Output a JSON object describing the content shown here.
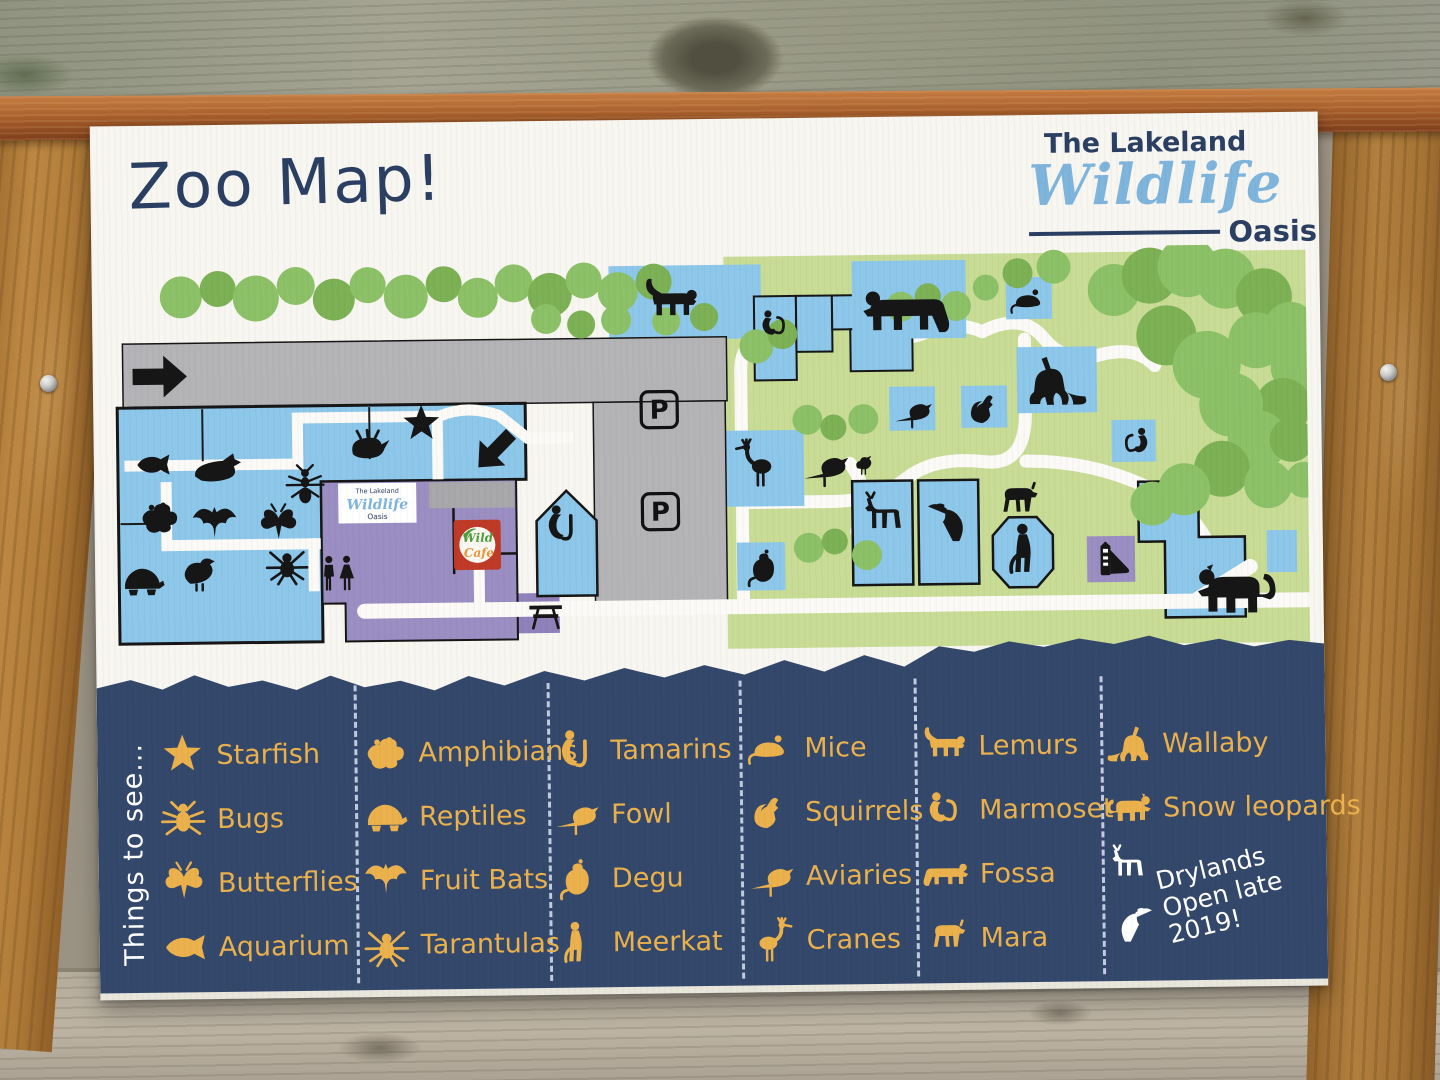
{
  "title": "Zoo Map!",
  "logo": {
    "top": "The Lakeland",
    "script": "Wildlife",
    "bottom": "Oasis"
  },
  "colors": {
    "navy_band": "#33486b",
    "gold": "#ebb14c",
    "sign_bg": "#f8f6f0",
    "map_green": "#c8dc96",
    "tree_green": "#8cc168",
    "enclosure_blue": "#8dc7ea",
    "parking_gray": "#b4b3b6",
    "building_purple": "#9b8ec3",
    "cafe_red": "#c03a28",
    "cafe_green": "#4e9c3c",
    "cafe_orange": "#e8953c",
    "logo_blue": "#7fb5dc",
    "logo_navy": "#2b3f63"
  },
  "map": {
    "parking_label": "P",
    "cafe": {
      "line1": "Wild",
      "line2": "Cafe"
    },
    "mini_sign": {
      "top": "The Lakeland",
      "script": "Wildlife",
      "bottom": "Oasis"
    },
    "markers": [
      {
        "icon": "clownfish",
        "x": 26,
        "y": 188,
        "s": 38
      },
      {
        "icon": "seal",
        "x": 84,
        "y": 182,
        "s": 52
      },
      {
        "icon": "conch",
        "x": 238,
        "y": 170,
        "s": 46
      },
      {
        "icon": "starfish",
        "x": 292,
        "y": 148,
        "s": 44
      },
      {
        "icon": "ant",
        "x": 176,
        "y": 208,
        "s": 42
      },
      {
        "icon": "frog",
        "x": 28,
        "y": 238,
        "s": 44
      },
      {
        "icon": "bat",
        "x": 82,
        "y": 244,
        "s": 48
      },
      {
        "icon": "butterfly",
        "x": 148,
        "y": 246,
        "s": 44
      },
      {
        "icon": "turtle",
        "x": 10,
        "y": 300,
        "s": 46
      },
      {
        "icon": "quail",
        "x": 70,
        "y": 292,
        "s": 44
      },
      {
        "icon": "spider",
        "x": 156,
        "y": 286,
        "s": 44
      },
      {
        "icon": "toilets",
        "x": 208,
        "y": 298,
        "s": 42
      },
      {
        "icon": "lemur",
        "x": 536,
        "y": 22,
        "s": 58
      },
      {
        "icon": "tamarin",
        "x": 432,
        "y": 250,
        "s": 44
      },
      {
        "icon": "marmoset",
        "x": 650,
        "y": 56,
        "s": 38
      },
      {
        "icon": "fossa",
        "x": 756,
        "y": 18,
        "s": 88,
        "flip": true
      },
      {
        "icon": "mouse",
        "x": 904,
        "y": 34,
        "s": 38
      },
      {
        "icon": "crane",
        "x": 624,
        "y": 188,
        "s": 50,
        "flip": true
      },
      {
        "icon": "aviary-bird",
        "x": 694,
        "y": 192,
        "s": 48
      },
      {
        "icon": "chick",
        "x": 744,
        "y": 202,
        "s": 26
      },
      {
        "icon": "pheasant",
        "x": 786,
        "y": 142,
        "s": 40
      },
      {
        "icon": "squirrel",
        "x": 858,
        "y": 140,
        "s": 42
      },
      {
        "icon": "wallaby",
        "x": 918,
        "y": 102,
        "s": 64,
        "flip": true
      },
      {
        "icon": "marmoset",
        "x": 1008,
        "y": 178,
        "s": 38,
        "flip": true
      },
      {
        "icon": "degu",
        "x": 634,
        "y": 296,
        "s": 42
      },
      {
        "icon": "mara",
        "x": 884,
        "y": 230,
        "s": 50
      },
      {
        "icon": "deer",
        "x": 750,
        "y": 242,
        "s": 54,
        "flip": true
      },
      {
        "icon": "hornbill",
        "x": 818,
        "y": 246,
        "s": 52,
        "flip": true
      },
      {
        "icon": "meerkat",
        "x": 890,
        "y": 274,
        "s": 56
      },
      {
        "icon": "snow-leopard",
        "x": 1086,
        "y": 304,
        "s": 82,
        "flip": true
      },
      {
        "icon": "slide",
        "x": 984,
        "y": 294,
        "s": 40
      },
      {
        "icon": "picnic",
        "x": 416,
        "y": 340,
        "s": 40
      },
      {
        "icon": "arrow",
        "x": 24,
        "y": 90,
        "s": 58
      },
      {
        "icon": "arrow",
        "x": 362,
        "y": 172,
        "s": 50,
        "rot": 135
      }
    ]
  },
  "legend": {
    "heading": "Things to see...",
    "columns": [
      {
        "items": [
          {
            "icon": "starfish",
            "label": "Starfish"
          },
          {
            "icon": "bug",
            "label": "Bugs"
          },
          {
            "icon": "butterfly",
            "label": "Butterflies"
          },
          {
            "icon": "clownfish",
            "label": "Aquarium"
          }
        ]
      },
      {
        "items": [
          {
            "icon": "frog",
            "label": "Amphibians"
          },
          {
            "icon": "turtle",
            "label": "Reptiles"
          },
          {
            "icon": "bat",
            "label": "Fruit Bats"
          },
          {
            "icon": "spider",
            "label": "Tarantulas"
          }
        ]
      },
      {
        "items": [
          {
            "icon": "tamarin",
            "label": "Tamarins"
          },
          {
            "icon": "pheasant",
            "label": "Fowl"
          },
          {
            "icon": "degu",
            "label": "Degu"
          },
          {
            "icon": "meerkat",
            "label": "Meerkat"
          }
        ]
      },
      {
        "items": [
          {
            "icon": "mouse",
            "label": "Mice"
          },
          {
            "icon": "squirrel",
            "label": "Squirrels"
          },
          {
            "icon": "aviary-bird",
            "label": "Aviaries"
          },
          {
            "icon": "crane",
            "label": "Cranes"
          }
        ]
      },
      {
        "items": [
          {
            "icon": "lemur",
            "label": "Lemurs"
          },
          {
            "icon": "marmoset",
            "label": "Marmoset"
          },
          {
            "icon": "fossa",
            "label": "Fossa"
          },
          {
            "icon": "mara",
            "label": "Mara"
          }
        ]
      },
      {
        "items": [
          {
            "icon": "wallaby",
            "label": "Wallaby"
          },
          {
            "icon": "snow-leopard",
            "label": "Snow leopards"
          }
        ],
        "note": {
          "icons": [
            "deer",
            "hornbill"
          ],
          "lines": [
            "Drylands",
            "Open late",
            "2019!"
          ]
        }
      }
    ]
  }
}
